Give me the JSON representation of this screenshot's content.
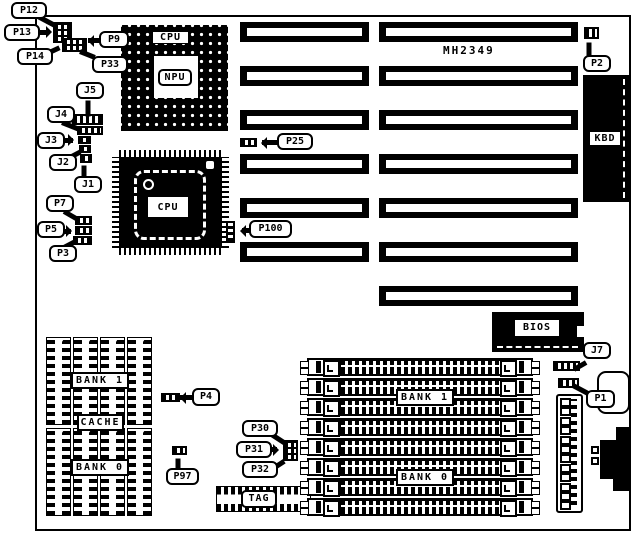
{
  "board": {
    "part_number": "MH2349"
  },
  "chips": {
    "pga_label": "CPU",
    "npu_label": "NPU",
    "qfp_label": "CPU",
    "bios_label": "BIOS",
    "kbd_label": "KBD",
    "tag_label": "TAG"
  },
  "cache": {
    "bank1_label": "BANK 1",
    "cache_label": "CACHE",
    "bank0_label": "BANK 0",
    "chip_count": 8
  },
  "memory": {
    "simm_count": 8,
    "bank1_label": "BANK 1",
    "bank0_label": "BANK 0"
  },
  "slots": {
    "left_count": 6,
    "right_count": 7
  },
  "power_connector": {
    "pin_count": 12
  },
  "callouts": {
    "p12": "P12",
    "p13": "P13",
    "p14": "P14",
    "p9": "P9",
    "p33": "P33",
    "j5": "J5",
    "j4": "J4",
    "j3": "J3",
    "j2": "J2",
    "j1": "J1",
    "p7": "P7",
    "p5": "P5",
    "p3": "P3",
    "p25": "P25",
    "p100": "P100",
    "p2": "P2",
    "j7": "J7",
    "p1": "P1",
    "p4": "P4",
    "p30": "P30",
    "p31": "P31",
    "p32": "P32",
    "p97": "P97"
  },
  "colors": {
    "ink": "#000000",
    "paper": "#ffffff"
  }
}
